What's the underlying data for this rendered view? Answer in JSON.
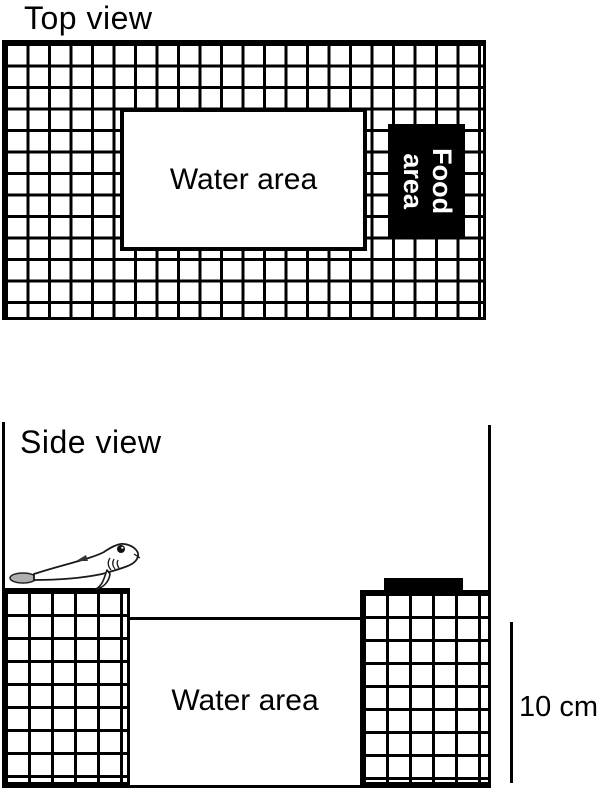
{
  "top_view": {
    "title": "Top view",
    "water_area_label": "Water area",
    "food_area_line1": "Food",
    "food_area_line2": "area"
  },
  "side_view": {
    "title": "Side view",
    "water_area_label": "Water area",
    "scale_label": "10 cm"
  },
  "colors": {
    "ink": "#000000",
    "background": "#ffffff",
    "food_area_bg": "#000000",
    "food_area_text": "#ffffff",
    "fish_tail_fill": "#b0b0b0"
  }
}
